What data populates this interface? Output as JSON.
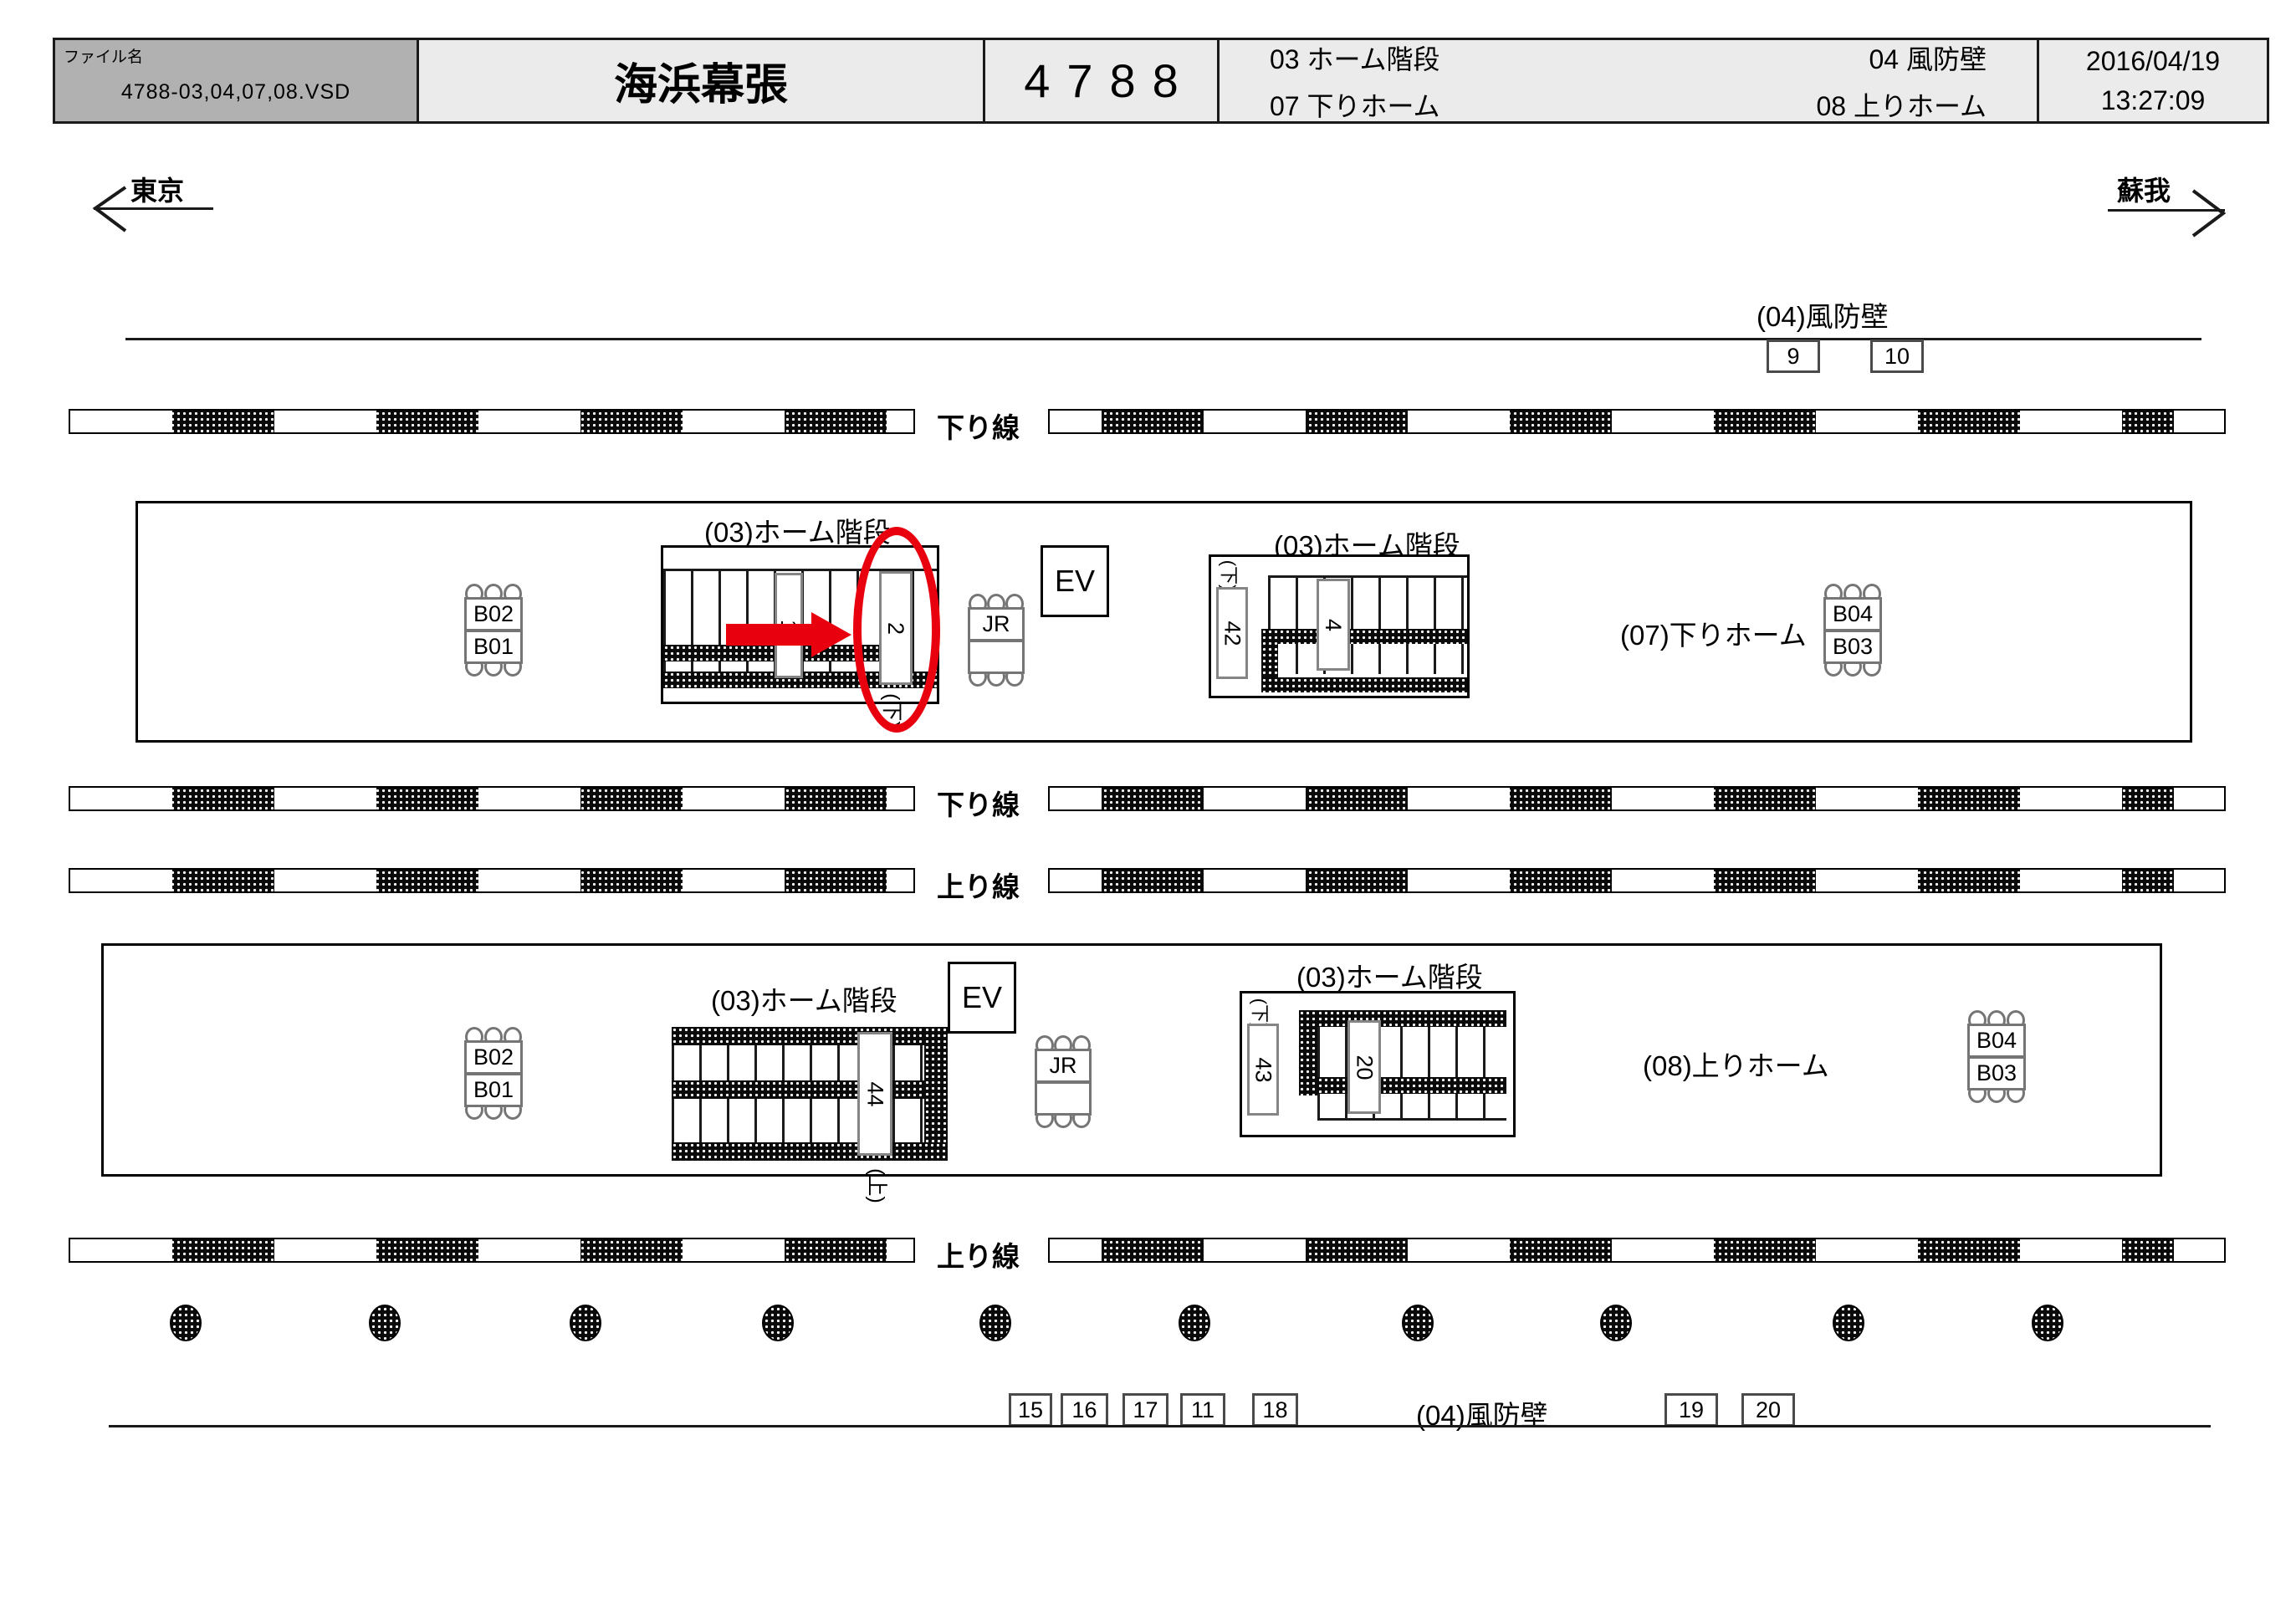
{
  "header": {
    "file_label": "ファイル名",
    "file_value": "4788-03,04,07,08.VSD",
    "station": "海浜幕張",
    "number": "4788",
    "cat_03": "03 ホーム階段",
    "cat_04": "04 風防壁",
    "cat_07": "07 下りホーム",
    "cat_08": "08 上りホーム",
    "date": "2016/04/19",
    "time": "13:27:09"
  },
  "directions": {
    "left": "東京",
    "right": "蘇我"
  },
  "top_windbreak": {
    "label": "(04)風防壁",
    "box_9": "9",
    "box_10": "10"
  },
  "tracks": {
    "row1": "下り線",
    "row2": "下り線",
    "row3": "上り線",
    "row4": "上り線"
  },
  "upper_platform": {
    "label": "(07)下りホーム",
    "stairs1_label": "(03)ホーム階段",
    "sign_1": "1",
    "sign_2": "2",
    "sign_2_sub": "(下)",
    "stairs2_label": "(03)ホーム階段",
    "stairs2_sub": "(下)",
    "sign_42": "42",
    "sign_4": "4",
    "bench_left_top": "B02",
    "bench_left_bottom": "B01",
    "bench_right_top": "B04",
    "bench_right_bottom": "B03",
    "jr": "JR",
    "ev": "EV"
  },
  "lower_platform": {
    "label": "(08)上りホーム",
    "stairs3_label": "(03)ホーム階段",
    "sign_44": "44",
    "sign_44_sub": "(上)",
    "stairs4_label": "(03)ホーム階段",
    "stairs4_sub": "(下)",
    "sign_43": "43",
    "sign_20": "20",
    "bench_left_top": "B02",
    "bench_left_bottom": "B01",
    "bench_right_top": "B04",
    "bench_right_bottom": "B03",
    "jr": "JR",
    "ev": "EV"
  },
  "bottom_windbreak": {
    "label": "(04)風防壁",
    "box_15": "15",
    "box_16": "16",
    "box_17": "17",
    "box_11": "11",
    "box_18": "18",
    "box_19": "19",
    "box_20": "20"
  },
  "colors": {
    "accent_red": "#e8000f",
    "header_gray": "#b1b1b1",
    "header_light": "#ebebeb"
  }
}
